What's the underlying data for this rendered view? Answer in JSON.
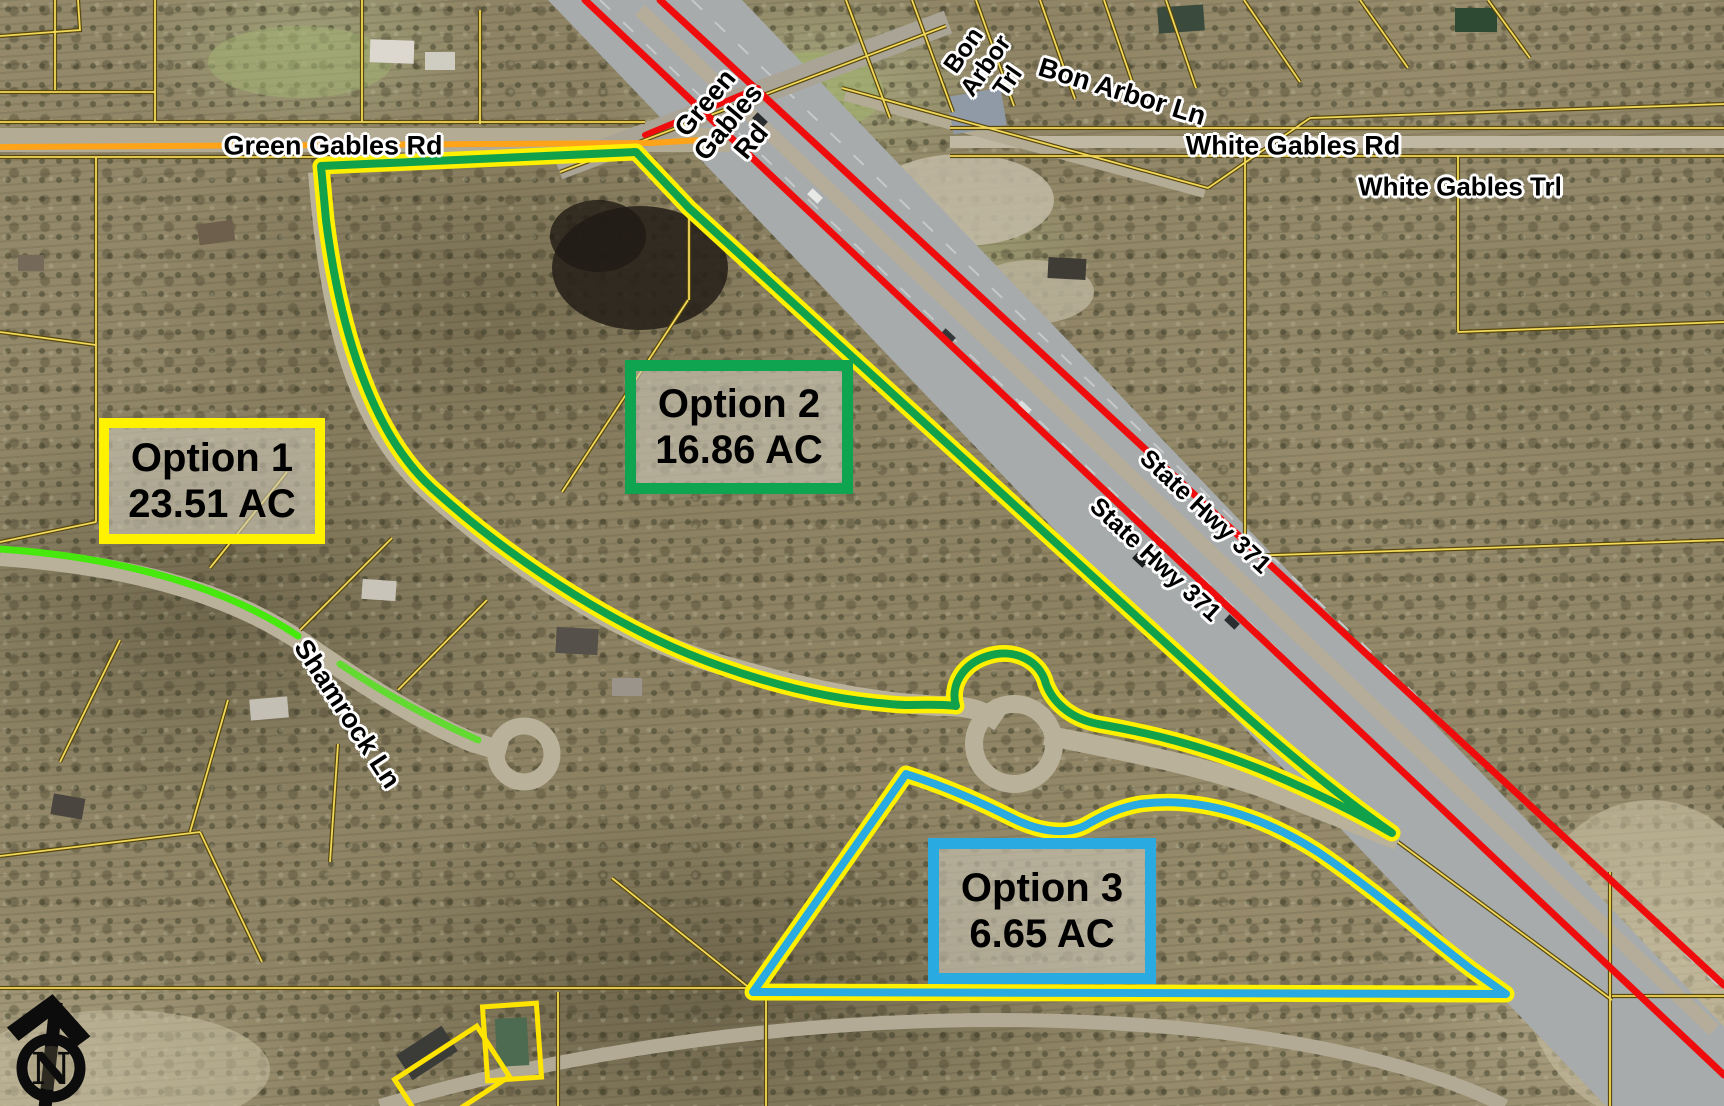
{
  "road_labels": {
    "green_gables_rd_west": "Green Gables Rd",
    "green_gables_rd_rotated": "Green Gables Rd",
    "bon_arbor_trl": "Bon Arbor Trl",
    "bon_arbor_ln": "Bon Arbor Ln",
    "white_gables_rd": "White Gables Rd",
    "white_gables_trl": "White Gables Trl",
    "state_hwy_371_a": "State Hwy 371",
    "state_hwy_371_b": "State Hwy 371",
    "shamrock_ln": "Shamrock Ln"
  },
  "options": [
    {
      "title": "Option 1",
      "area": "23.51 AC",
      "border_color": "#FFF200"
    },
    {
      "title": "Option 2",
      "area": "16.86 AC",
      "border_color": "#0FA450"
    },
    {
      "title": "Option 3",
      "area": "6.65 AC",
      "border_color": "#29ABE2"
    }
  ],
  "north_arrow": {
    "letter": "N"
  },
  "colors": {
    "boundary_yellow": "#FFF000",
    "boundary_green": "#12A14B",
    "boundary_blue": "#29ABE2",
    "highway_red": "#EE0C0C",
    "road_overlay_orange": "#FFA319",
    "road_overlay_green": "#46E80E",
    "parcel_line_yellow": "#F3D95A",
    "highlight_parcel_yellow": "#FFE400"
  }
}
